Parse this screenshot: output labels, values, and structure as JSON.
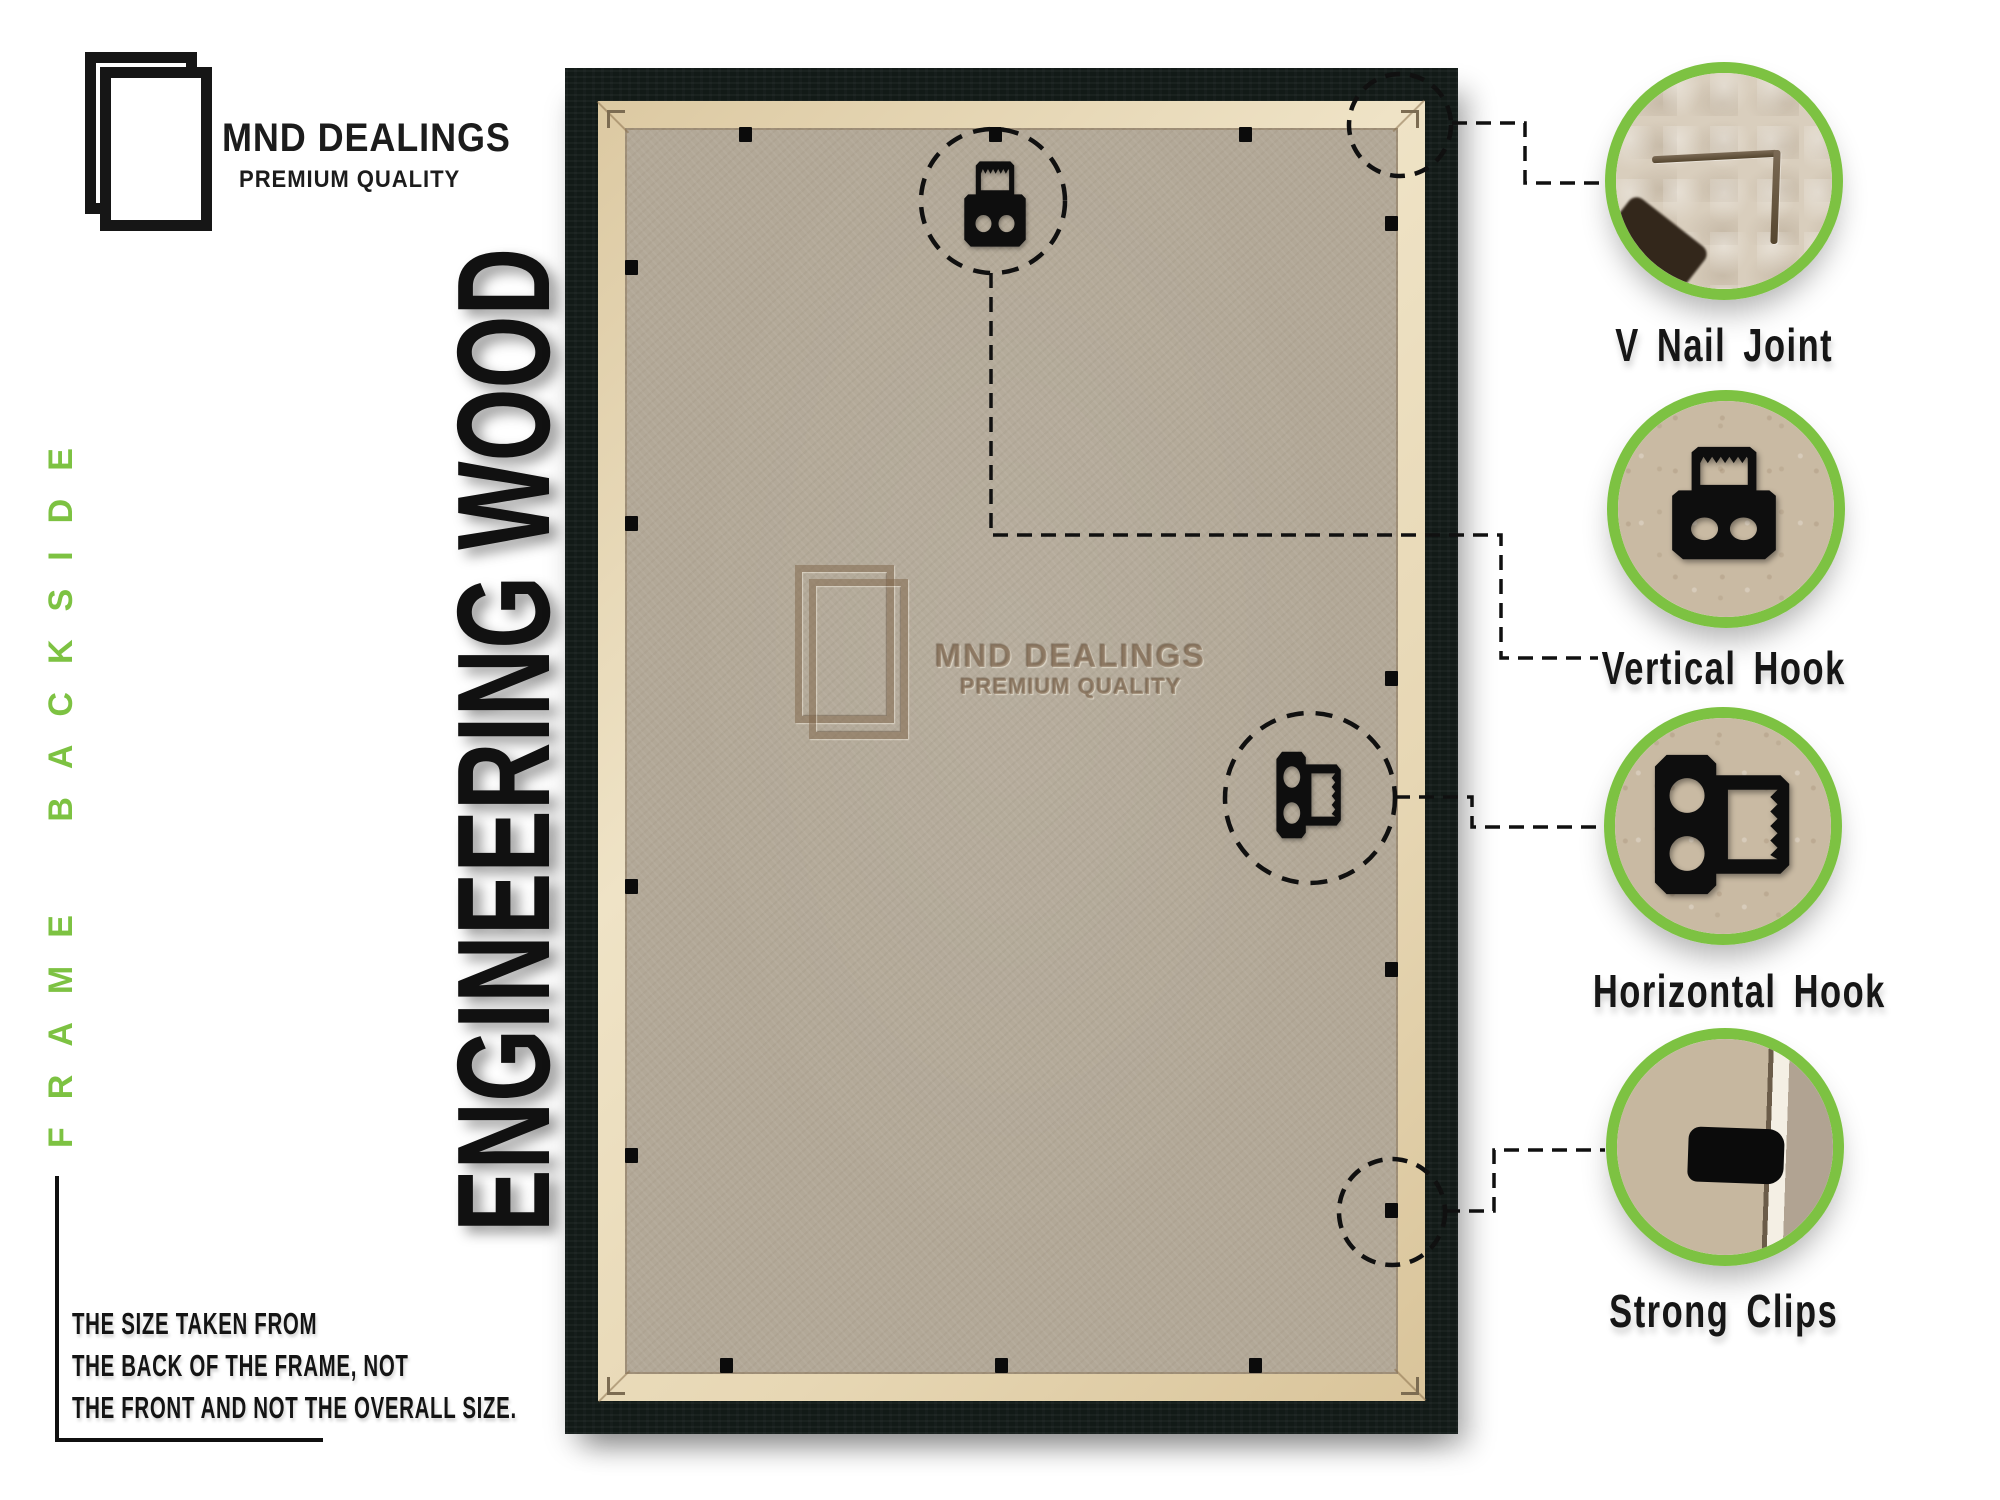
{
  "brand": {
    "name": "MND DEALINGS",
    "tagline": "PREMIUM QUALITY"
  },
  "side_labels": {
    "backside": "FRAME BACKSIDE",
    "material": "ENGINEERING WOOD"
  },
  "watermark": {
    "name": "MND DEALINGS",
    "tagline": "PREMIUM QUALITY"
  },
  "callouts": [
    {
      "label": "V Nail Joint",
      "icon": "v-nail-joint-photo"
    },
    {
      "label": "Vertical Hook",
      "icon": "vertical-hook-icon"
    },
    {
      "label": "Horizontal Hook",
      "icon": "horizontal-hook-icon"
    },
    {
      "label": "Strong Clips",
      "icon": "strong-clip-icon"
    }
  ],
  "note": {
    "lines": [
      "THE SIZE TAKEN FROM",
      "THE BACK OF THE FRAME, NOT",
      "THE FRONT AND NOT THE OVERALL SIZE."
    ]
  },
  "colors": {
    "accent_green": "#7dc242",
    "frame_black": "#121a17",
    "board_tan": "#b2a897",
    "lip_cream": "#e9dcbd",
    "ink": "#121212"
  },
  "frame": {
    "clips": {
      "top_x": [
        745,
        995,
        1245
      ],
      "bottom_x": [
        726,
        1001,
        1255
      ],
      "left_y": [
        267,
        523,
        886,
        1155
      ],
      "right_y": [
        223,
        678,
        969,
        1210
      ]
    }
  }
}
